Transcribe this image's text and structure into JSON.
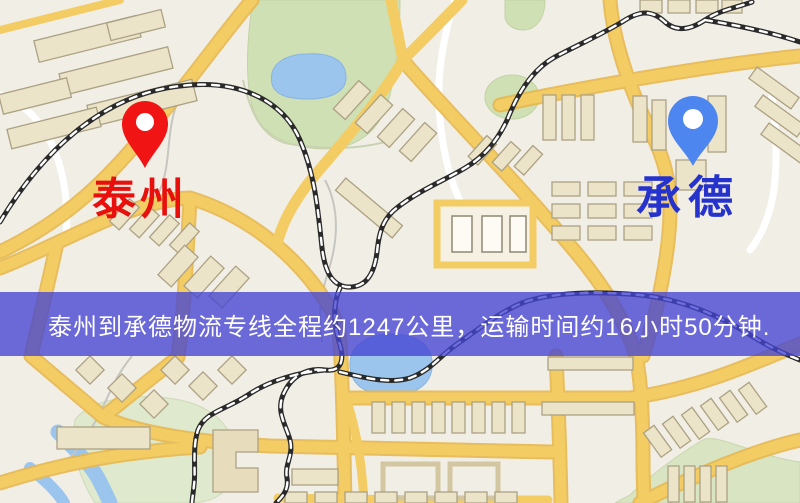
{
  "window": {
    "width": 800,
    "height": 503,
    "type": "map-view"
  },
  "map": {
    "markers": [
      {
        "id": "origin",
        "label": "泰州",
        "pin_icon": "map-pin",
        "pin_color": "#f01414",
        "label_color": "#e8100c"
      },
      {
        "id": "destination",
        "label": "承德",
        "pin_icon": "map-pin",
        "pin_color": "#4e86f0",
        "label_color": "#2533cc"
      }
    ],
    "colors": {
      "land": "#f1eee6",
      "park": "#cfe0b4",
      "park_pale": "#dfe9cd",
      "water": "#9cc5ee",
      "road_major": "#f3cc63",
      "road_casing": "#e7b850",
      "road_minor": "#ffffff",
      "building_fill": "#ece4c9",
      "building_stroke": "#aca183",
      "railway": "#2a2a2a"
    }
  },
  "banner": {
    "text": "泰州到承德物流专线全程约1247公里，运输时间约16小时50分钟.",
    "background": "#4444d2",
    "opacity": 0.78,
    "text_color": "#ffffff"
  }
}
